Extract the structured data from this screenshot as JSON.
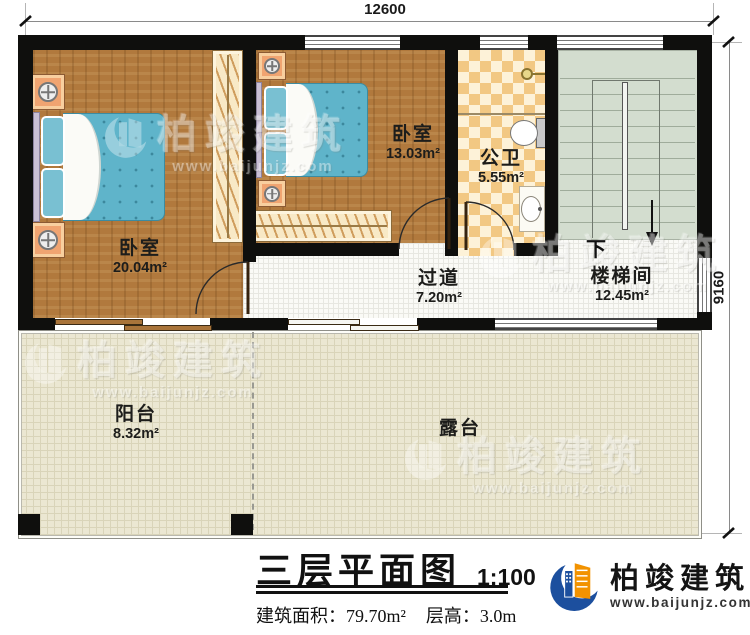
{
  "plan": {
    "dimensions": {
      "width_mm": "12600",
      "height_mm": "9160"
    },
    "rooms": [
      {
        "label": "卧室",
        "area": "20.04m²"
      },
      {
        "label": "卧室",
        "area": "13.03m²"
      },
      {
        "label": "公卫",
        "area": "5.55m²"
      },
      {
        "label": "过道",
        "area": "7.20m²"
      },
      {
        "label": "楼梯间",
        "area": "12.45m²"
      },
      {
        "label": "阳台",
        "area": "8.32m²"
      },
      {
        "label": "露台",
        "area": ""
      }
    ],
    "stair_direction": "下"
  },
  "title_block": {
    "title": "三层平面图",
    "scale": "1:100",
    "building_area": "建筑面积：79.70m²",
    "floor_height": "层高：3.0m"
  },
  "brand": {
    "name": "柏竣建筑",
    "website": "www.baijunjz.com"
  },
  "watermark": {
    "name": "柏竣建筑",
    "website": "www.baijunjz.com"
  },
  "colors": {
    "wall": "#0f0f0d",
    "wood_floor": "#b1793d",
    "bath_checker": "#f2c883",
    "stair_green": "#d3ddcf",
    "terrace_beige": "#ebe7d2",
    "brand_blue": "#1c4f9e",
    "brand_orange": "#f29200"
  }
}
